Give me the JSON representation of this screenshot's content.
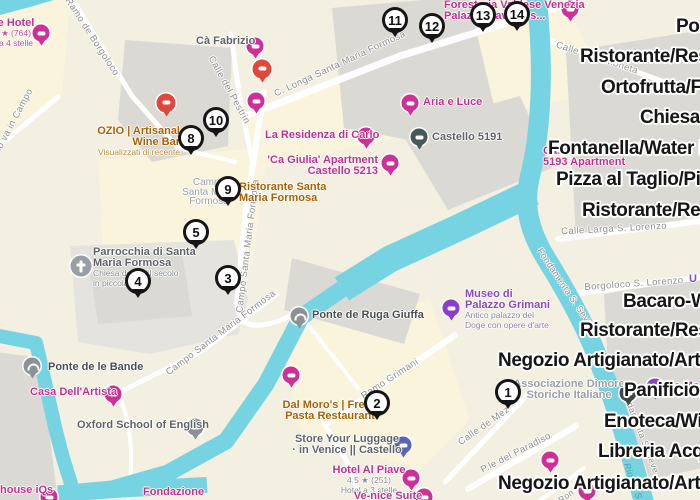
{
  "colors": {
    "land": "#f3efe1",
    "campo": "#faf4dd",
    "bld": "#dbd9d3",
    "bldlight": "#e5e3de",
    "water": "#76d4e2",
    "pink": "#c92d8f",
    "orange": "#ad5f00",
    "gray": "#5f6368",
    "graylight": "#9aa0a6",
    "purple": "#8a48c8",
    "marker_border": "#151515",
    "overlay_text": "#161616"
  },
  "overlay_labels": [
    {
      "text": "Por",
      "x": 676,
      "y": 27
    },
    {
      "text": "Ristorante/Rest",
      "x": 580,
      "y": 57
    },
    {
      "text": "Ortofrutta/Fru",
      "x": 601,
      "y": 88
    },
    {
      "text": "Chiesa/C",
      "x": 640,
      "y": 118
    },
    {
      "text": "Fontanella/Water Fo",
      "x": 548,
      "y": 149
    },
    {
      "text": "Pizza al Taglio/Pizza",
      "x": 556,
      "y": 180
    },
    {
      "text": "Ristorante/Rest",
      "x": 582,
      "y": 211
    },
    {
      "text": "Bacaro-Wi",
      "x": 623,
      "y": 302
    },
    {
      "text": "Ristorante/Rest",
      "x": 580,
      "y": 331
    },
    {
      "text": "Negozio Artigianato/Artisan",
      "x": 498,
      "y": 361
    },
    {
      "text": "Panificio/",
      "x": 624,
      "y": 391
    },
    {
      "text": "Enoteca/Win",
      "x": 604,
      "y": 422
    },
    {
      "text": "Libreria Acqu",
      "x": 598,
      "y": 452
    },
    {
      "text": "Negozio Artigianato/Artisan",
      "x": 498,
      "y": 484
    }
  ],
  "markers": [
    {
      "num": "1",
      "x": 508,
      "y": 392
    },
    {
      "num": "2",
      "x": 377,
      "y": 403
    },
    {
      "num": "3",
      "x": 228,
      "y": 278
    },
    {
      "num": "4",
      "x": 138,
      "y": 281
    },
    {
      "num": "5",
      "x": 196,
      "y": 232
    },
    {
      "num": "8",
      "x": 191,
      "y": 138
    },
    {
      "num": "9",
      "x": 228,
      "y": 189
    },
    {
      "num": "10",
      "x": 216,
      "y": 120
    },
    {
      "num": "11",
      "x": 395,
      "y": 20
    },
    {
      "num": "12",
      "x": 432,
      "y": 26
    },
    {
      "num": "13",
      "x": 483,
      "y": 15
    },
    {
      "num": "14",
      "x": 517,
      "y": 14
    }
  ],
  "streets": [
    {
      "name": "Ramo de Borgoloco",
      "x": 92,
      "y": 37,
      "angle": 57
    },
    {
      "name": "Ramo va in Campo",
      "x": 10,
      "y": 128,
      "angle": -62
    },
    {
      "name": "Calle del Pestrin",
      "x": 229,
      "y": 90,
      "angle": 61
    },
    {
      "name": "C. Longa Santa Maria Formosa",
      "x": 340,
      "y": 64,
      "angle": -25
    },
    {
      "name": "Campo Santa Maria Formosa",
      "x": 248,
      "y": 246,
      "angle": -83
    },
    {
      "name": "Campo Santa Maria Formosa",
      "x": 221,
      "y": 333,
      "angle": -37
    },
    {
      "name": "Ramo Grimani",
      "x": 390,
      "y": 379,
      "angle": -33
    },
    {
      "name": "Calle de Mez",
      "x": 484,
      "y": 426,
      "angle": -35
    },
    {
      "name": "P.le del Paradiso",
      "x": 516,
      "y": 453,
      "angle": -27
    },
    {
      "name": "Borgoloco S. Lorenzo",
      "x": 634,
      "y": 284,
      "angle": -4
    },
    {
      "name": "Calle Larga S. Lorenzo",
      "x": 614,
      "y": 229,
      "angle": -3
    },
    {
      "name": "Calle della Moneta",
      "x": 597,
      "y": 58,
      "angle": 18
    },
    {
      "name": "Fondamenta S. Seve",
      "x": 565,
      "y": 287,
      "angle": 56,
      "size": 9
    },
    {
      "name": "Fondamenta S. Seve",
      "x": 640,
      "y": 430,
      "angle": 69,
      "size": 9
    },
    {
      "name": "Rio de S",
      "x": 633,
      "y": 481,
      "angle": 70,
      "size": 9,
      "kind": "water-name"
    },
    {
      "name": "Ron",
      "x": 566,
      "y": 496,
      "angle": -35,
      "size": 8.5
    }
  ],
  "pois": [
    {
      "id": "campo-name",
      "lines": [],
      "sub": [
        "Campo",
        "Santa Maria",
        "Formosa"
      ],
      "sub_color": "#9aa0a6",
      "sub_size": 10,
      "color": "graylight",
      "x": 209,
      "y": 178,
      "align": "center"
    },
    {
      "id": "parrocchia-santa-maria-formosa",
      "lines": [
        "Parrocchia di Santa",
        "Maria Formosa"
      ],
      "sub": [
        "Chiesa del XVII secolo",
        "in piccola..."
      ],
      "color": "gray",
      "x": 93,
      "y": 247,
      "align": "left",
      "icon": {
        "type": "church",
        "x": 81,
        "y": 266
      }
    },
    {
      "id": "hotel-topleft",
      "lines": [
        "e Hotel"
      ],
      "sub": [
        "★ (764)",
        "a 4 stelle"
      ],
      "sub_color": "#c94a9c",
      "color": "pink",
      "x": 16,
      "y": 18,
      "align": "center",
      "icon": {
        "type": "pink",
        "x": 41,
        "y": 33
      }
    },
    {
      "id": "ca-fabrizio",
      "lines": [
        "Cà Fabrizio"
      ],
      "color": "gray",
      "x": 196,
      "y": 36,
      "align": "left",
      "icon": {
        "type": "pink",
        "x": 255,
        "y": 46
      }
    },
    {
      "id": "ozio-wine-bar",
      "lines": [
        "OZIO | Artisanal",
        "Wine Bar"
      ],
      "sub": [
        "Visualizzati di recente"
      ],
      "sub_color": "#bd8e35",
      "color": "orange",
      "x": 180,
      "y": 126,
      "align": "right"
    },
    {
      "id": "la-residenza-di-carlo",
      "lines": [
        "La Residenza di Carlo"
      ],
      "color": "pink",
      "x": 265,
      "y": 130,
      "align": "left",
      "icon": {
        "type": "pink",
        "x": 366,
        "y": 136
      }
    },
    {
      "id": "ca-giulia-apartment",
      "lines": [
        "'Ca Giulia' Apartment",
        "Castello 5213"
      ],
      "color": "pink",
      "x": 378,
      "y": 155,
      "align": "right",
      "icon": {
        "type": "pink",
        "x": 390,
        "y": 163
      }
    },
    {
      "id": "aria-e-luce",
      "lines": [
        "Aria e Luce"
      ],
      "color": "pink",
      "x": 423,
      "y": 97,
      "align": "left",
      "icon": {
        "type": "pink",
        "x": 410,
        "y": 103
      }
    },
    {
      "id": "castello-5191",
      "lines": [
        "Castello 5191"
      ],
      "color": "gray",
      "x": 432,
      "y": 132,
      "align": "left",
      "icon": {
        "type": "dark",
        "x": 419,
        "y": 137
      }
    },
    {
      "id": "foresteria-valdese",
      "lines": [
        "Foresteria Valdese Venezia",
        "Palazzo Cavagnis..."
      ],
      "color": "pink",
      "x": 444,
      "y": 0,
      "align": "left",
      "icon": {
        "type": "pink",
        "x": 570,
        "y": 9
      }
    },
    {
      "id": "casamisa-formosa",
      "lines": [
        "CasaMisa Formosa",
        "5193 Apartment"
      ],
      "color": "pink",
      "x": 543,
      "y": 146,
      "align": "left"
    },
    {
      "id": "ristorante-santa-maria-formosa",
      "lines": [
        "Ristorante Santa",
        "Maria Formosa"
      ],
      "color": "orange",
      "x": 239,
      "y": 182,
      "align": "left"
    },
    {
      "id": "museo-di-palazzo-grimani",
      "lines": [
        "Museo di",
        "Palazzo Grimani"
      ],
      "sub": [
        "Antico palazzo del",
        "Doge con opere d'arte"
      ],
      "sub_color": "#9181a8",
      "color": "purple",
      "x": 465,
      "y": 289,
      "align": "left",
      "icon": {
        "type": "purple",
        "x": 451,
        "y": 308
      }
    },
    {
      "id": "associazione-dimore",
      "lines": [
        "Associazione Dimore",
        "Storiche Italiane"
      ],
      "color": "graylight",
      "x": 569,
      "y": 379,
      "align": "center"
    },
    {
      "id": "ponte-de-ruga-giuffa",
      "lines": [
        "Ponte de Ruga Giuffa"
      ],
      "color": "graydark",
      "x": 312,
      "y": 310,
      "align": "left",
      "icon": {
        "type": "bridge",
        "x": 299,
        "y": 316
      }
    },
    {
      "id": "ponte-de-le-bande",
      "lines": [
        "Ponte de le Bande"
      ],
      "color": "graydark",
      "x": 48,
      "y": 362,
      "align": "left",
      "icon": {
        "type": "bridge",
        "x": 32,
        "y": 366
      }
    },
    {
      "id": "casa-dell-artista",
      "lines": [
        "Casa Dell'Artista"
      ],
      "color": "pink",
      "x": 30,
      "y": 387,
      "align": "left",
      "icon": {
        "type": "pink",
        "x": 113,
        "y": 394
      }
    },
    {
      "id": "oxford-school-of-english",
      "lines": [
        "Oxford School of English"
      ],
      "color": "gray",
      "x": 77,
      "y": 420,
      "align": "left",
      "icon": {
        "type": "gray",
        "x": 195,
        "y": 427
      }
    },
    {
      "id": "dal-moros",
      "lines": [
        "Dal Moro's | Fresh",
        "Pasta Restaurant"
      ],
      "color": "orange",
      "x": 330,
      "y": 400,
      "align": "center"
    },
    {
      "id": "store-your-luggage",
      "lines": [
        "Store Your Luggage",
        "· in Venice || Castello"
      ],
      "color": "gray",
      "x": 347,
      "y": 434,
      "align": "center",
      "icon": {
        "type": "indigo",
        "x": 403,
        "y": 445
      }
    },
    {
      "id": "hotel-al-piave",
      "lines": [
        "Hotel Al Piave"
      ],
      "sub": [
        "4.5 ★ (251)",
        "Hotel a 3 stelle"
      ],
      "sub_color": "#8b8b8b",
      "color": "pink",
      "x": 369,
      "y": 465,
      "align": "center",
      "icon": {
        "type": "pink",
        "x": 411,
        "y": 478
      }
    },
    {
      "id": "ve-nice-suite",
      "lines": [
        "Ve-nice Suite"
      ],
      "color": "pink",
      "x": 388,
      "y": 491,
      "align": "center",
      "icon": {
        "type": "pink",
        "x": 424,
        "y": 497
      }
    },
    {
      "id": "house-iqs",
      "lines": [
        "house iQs"
      ],
      "color": "pink",
      "x": 0,
      "y": 485,
      "align": "left",
      "icon": {
        "type": "pink",
        "x": 49,
        "y": 497
      }
    },
    {
      "id": "fondazione",
      "lines": [
        "Fondazione"
      ],
      "color": "pink",
      "x": 143,
      "y": 487,
      "align": "left"
    },
    {
      "id": "the-ma-fragment",
      "lines": [
        "The Ma"
      ],
      "color": "pink",
      "x": 661,
      "y": 381,
      "align": "left"
    },
    {
      "id": "u-fragment",
      "lines": [
        "U"
      ],
      "color": "purple",
      "x": 689,
      "y": 274,
      "align": "left"
    }
  ],
  "loose_icons": [
    {
      "type": "red",
      "x": 166,
      "y": 103
    },
    {
      "type": "red",
      "x": 262,
      "y": 69
    },
    {
      "type": "pink",
      "x": 256,
      "y": 101
    },
    {
      "type": "pink",
      "x": 291,
      "y": 375
    },
    {
      "type": "pink",
      "x": 550,
      "y": 460
    },
    {
      "type": "pink",
      "x": 587,
      "y": 491
    },
    {
      "type": "dark2",
      "x": 628,
      "y": 393
    },
    {
      "type": "purple",
      "x": 655,
      "y": 387
    }
  ]
}
